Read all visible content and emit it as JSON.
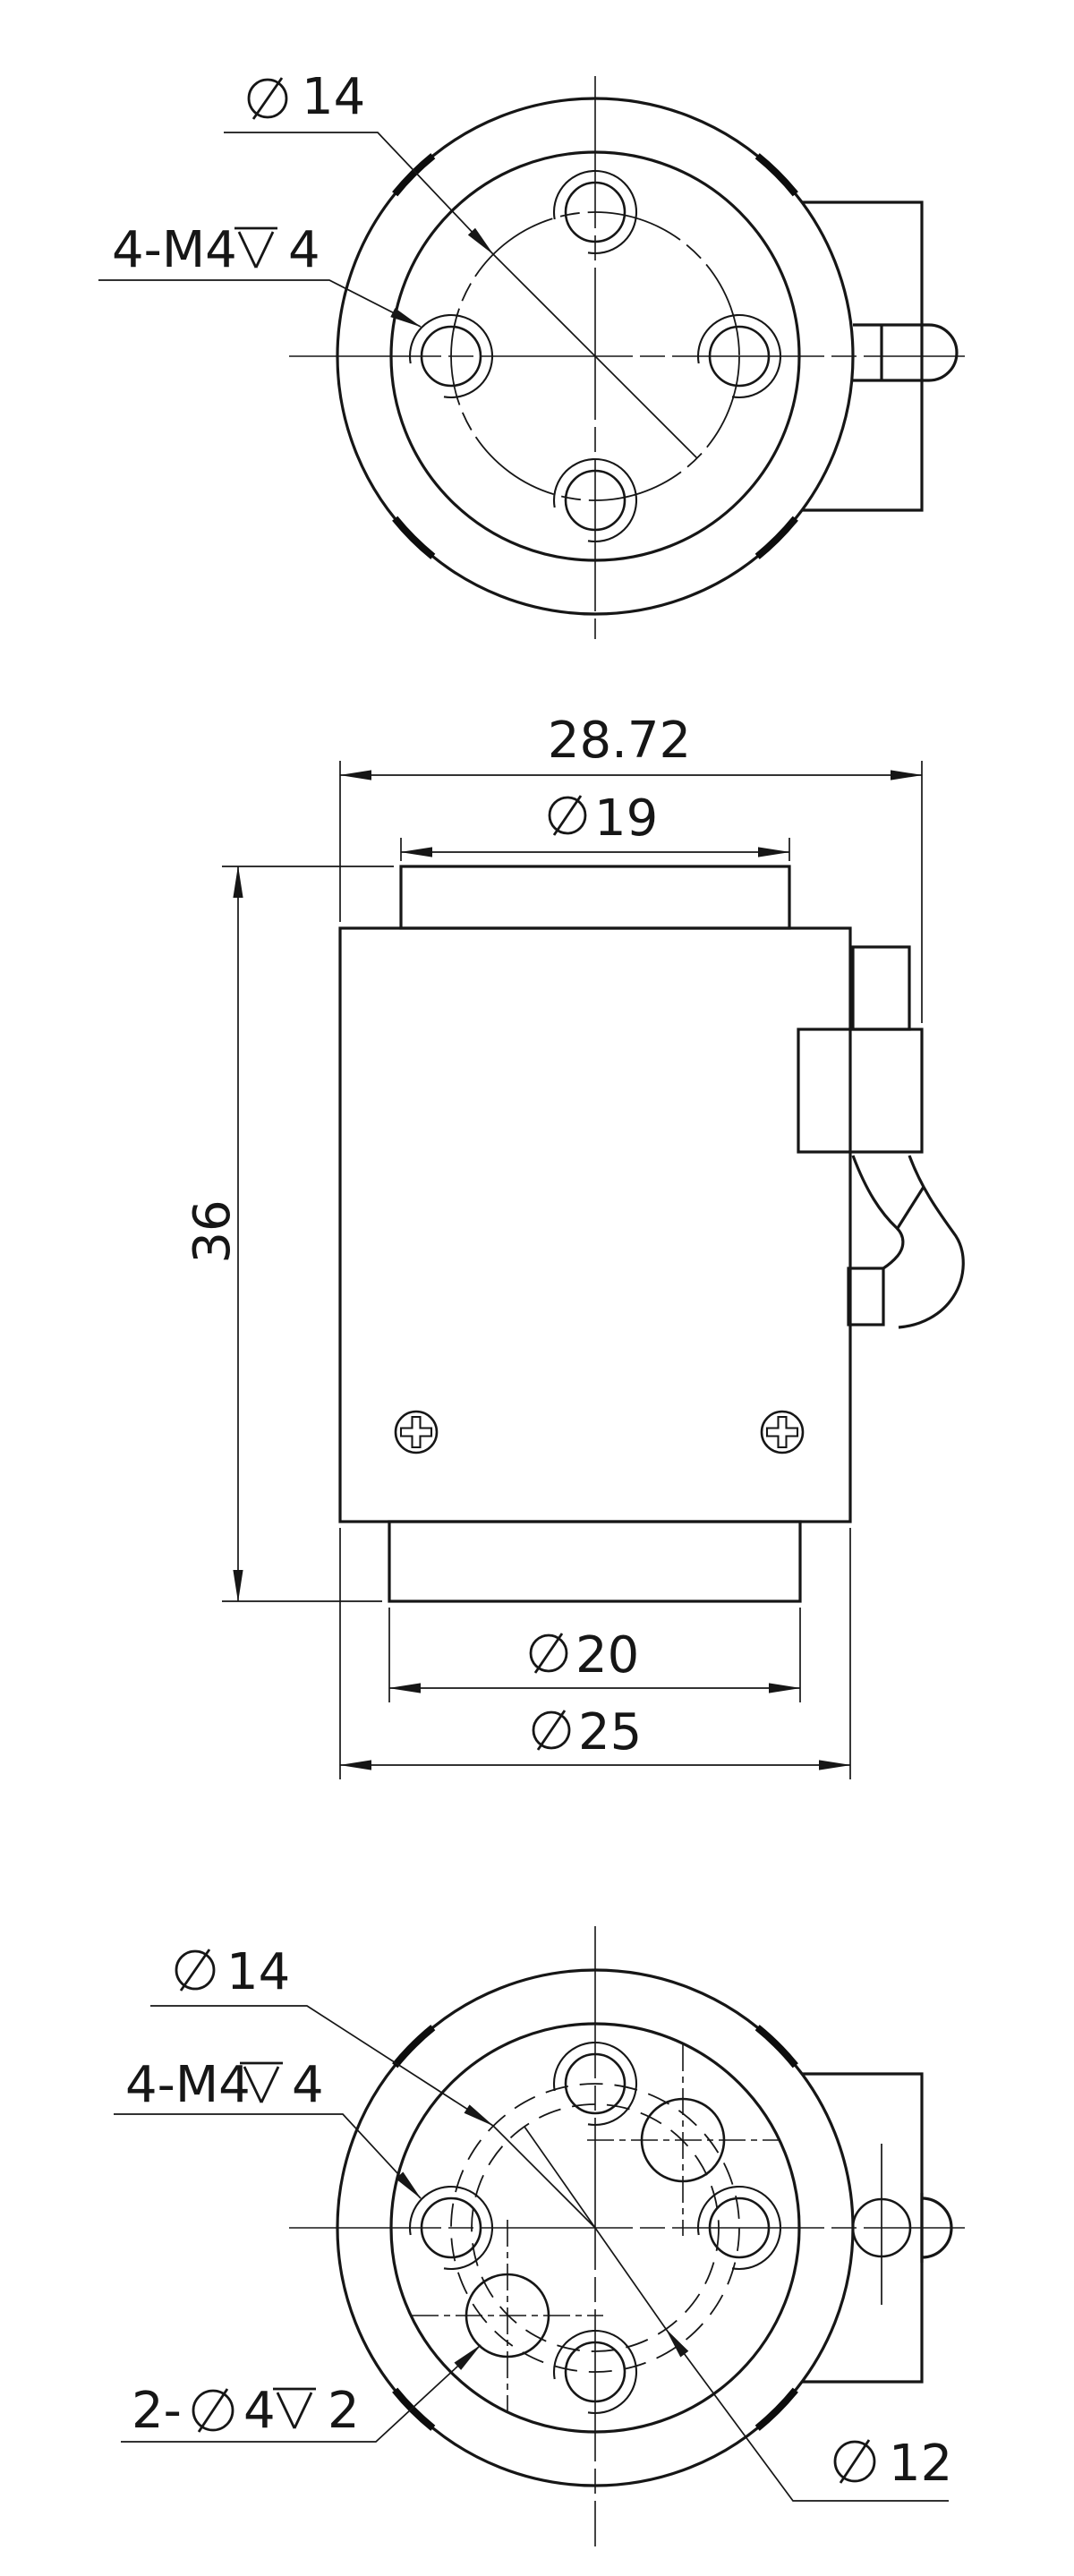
{
  "canvas": {
    "background": "#ffffff",
    "line_color": "#161616"
  },
  "drawing": {
    "top_view": {
      "bolt_circle_dia": "14",
      "tapped_holes_prefix": "4-M4",
      "tapped_holes_depth": "4"
    },
    "front_view": {
      "overall_width": "28.72",
      "boss_dia": "19",
      "height": "36",
      "hub_dia": "20",
      "body_dia": "25"
    },
    "bottom_view": {
      "bolt_circle_dia": "14",
      "tapped_holes_prefix": "4-M4",
      "tapped_holes_depth": "4",
      "small_holes_prefix": "2-",
      "small_holes_dia": "4",
      "small_holes_depth": "2",
      "hole_circle_dia": "12"
    }
  }
}
